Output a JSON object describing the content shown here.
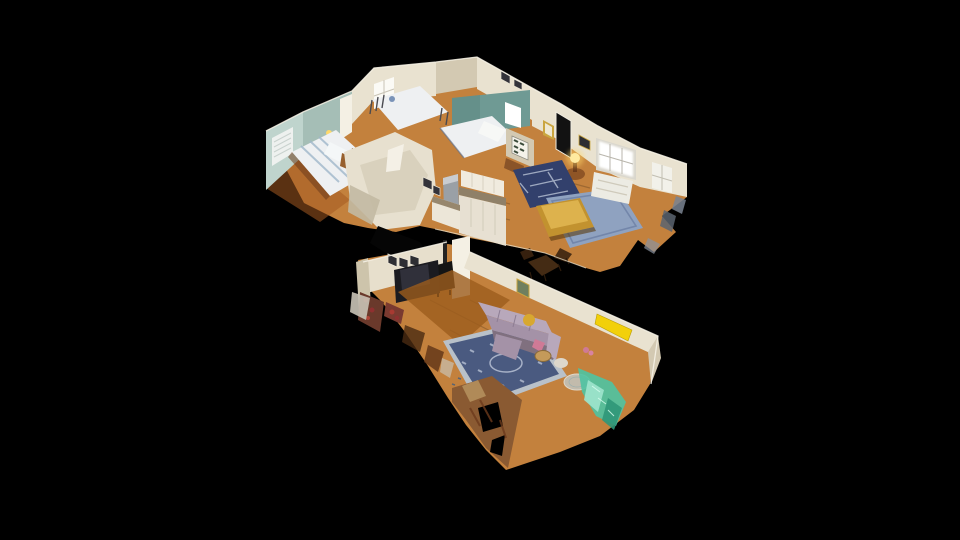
{
  "viewer": {
    "type": "3d-dollhouse-cutaway",
    "chrome": "none",
    "background_color": "#000000",
    "description": "Photogrammetry dollhouse cutaway view of a single-story residence floating on a black background, seen from an elevated oblique angle with ragged scan edges"
  },
  "palette": {
    "bg": "#000000",
    "wall-cream": "#e9e2d0",
    "wall-cream-shade": "#d3c9b2",
    "wall-cream-dark": "#b3a88d",
    "wall-bright": "#f4f0e4",
    "wall-seafoam": "#bfd4cd",
    "wall-seafoam-shade": "#a5beb6",
    "wall-teal": "#6f9a94",
    "wall-teal-light": "#8fb3ab",
    "window-glow": "#ffffff",
    "floor-wood": "#c3813d",
    "floor-wood-dark": "#a9671f",
    "floor-wood-light": "#d89c55",
    "rug-navy": "#32406c",
    "rug-navy-light": "#b9c3d6",
    "rug-slate": "#8fa2c0",
    "rug-living": "#4a5a80",
    "rug-living-light": "#b7c1d3",
    "sofa-lavender": "#a492a7",
    "sofa-lavender-light": "#b8a8bb",
    "sofa-lavender-dark": "#80707f",
    "couch-gold": "#c2922f",
    "couch-gold-light": "#e3ba55",
    "pillow-yellow": "#d8a830",
    "accent-yellow": "#f2d00a",
    "glass-teal": "#4fc3a2",
    "glass-teal-light": "#9fe4cd",
    "glass-teal-dark": "#2f9678",
    "bed-white": "#eef0f2",
    "furniture-dark": "#1b1b20",
    "door-black": "#121212",
    "wood-brown": "#8a5428",
    "wood-red": "#7a3a30",
    "frag-brown": "#8a5a32",
    "frag-tan": "#b08a58",
    "metal-gray": "#9aa0a6",
    "lamp-gold": "#ffd96a",
    "pink-accent": "#cf7a96"
  },
  "scene": {
    "rooms": [
      {
        "id": "bedroom-seafoam",
        "features": [
          "white-and-blue-striped-bed",
          "window-with-white-blinds",
          "wood-headboard-and-nightstand",
          "yellow-wall-lamp",
          "white-door"
        ]
      },
      {
        "id": "bedroom-white",
        "features": [
          "metal-frame-bed",
          "bright-sheer-curtain-window",
          "framed-art"
        ]
      },
      {
        "id": "bedroom-teal",
        "features": [
          "white-duvet-bed",
          "bright-window",
          "teal-walls"
        ]
      },
      {
        "id": "foyer",
        "features": [
          "black-front-door",
          "gilt-mirror",
          "botanical-print-grid-frame",
          "console-table",
          "round-table-with-glowing-gold-lamp",
          "navy-oriental-runner"
        ]
      },
      {
        "id": "living-room-upper",
        "features": [
          "large-bright-window",
          "white-loveseat",
          "gold-settee",
          "slate-blue-rug",
          "hardwood-floor"
        ]
      },
      {
        "id": "kitchen",
        "features": [
          "stainless-refrigerator",
          "white-cabinets",
          "dark-countertop"
        ]
      },
      {
        "id": "dining-nook",
        "features": [
          "dark-wood-table-and-chairs"
        ]
      },
      {
        "id": "den",
        "features": [
          "row-of-framed-pictures",
          "dark-media-console",
          "black-wood-stove",
          "white-chimney-column"
        ]
      },
      {
        "id": "living-room-lower",
        "features": [
          "lavender-sectional-sofa",
          "mustard-round-pouf",
          "pink-throw",
          "blue-oriental-rug-with-light-border",
          "glass-coffee-table",
          "wicker-basket",
          "bright-yellow-cut-wall-edge",
          "small-green-framed-art",
          "hardwood-floor"
        ]
      },
      {
        "id": "scan-artifacts",
        "features": [
          "ragged-mesh-edges",
          "teal-glass-fragments",
          "brown-floor-fragments",
          "black-holes"
        ]
      }
    ]
  }
}
